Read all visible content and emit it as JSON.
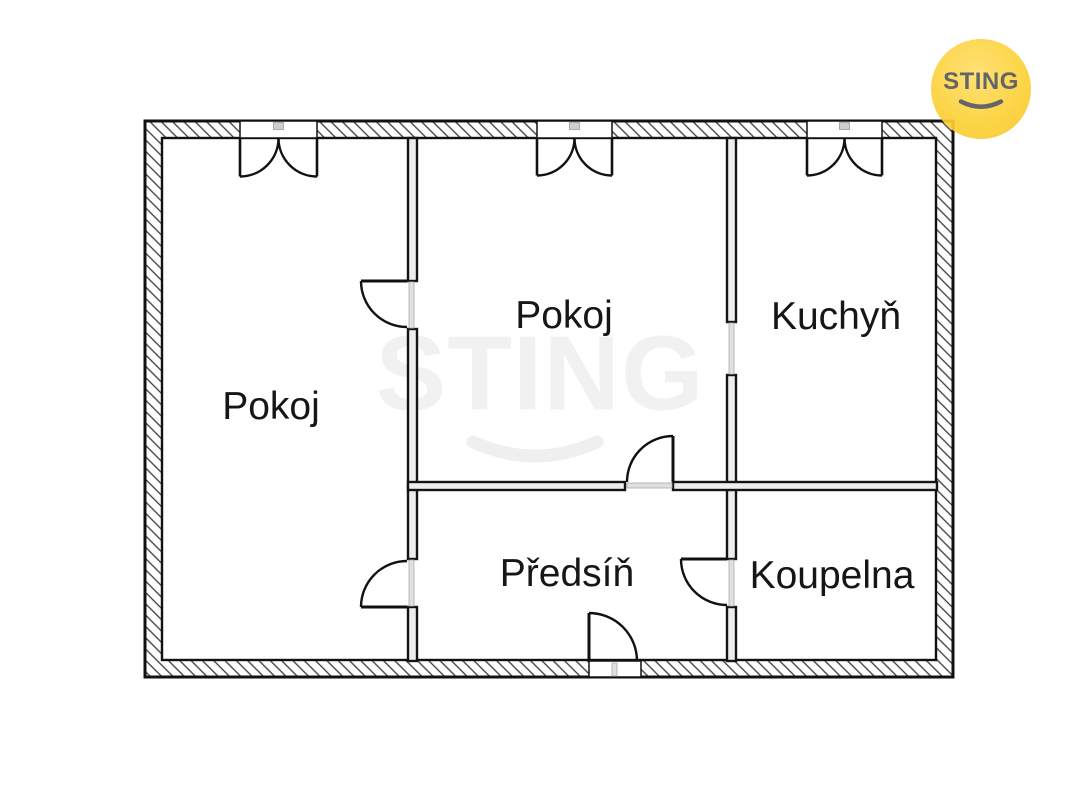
{
  "page": {
    "background": "#ffffff",
    "width": 1067,
    "height": 800
  },
  "branding": {
    "logo_text": "STING",
    "logo_circle_color": "#fbce2e",
    "logo_text_color": "#57585c",
    "watermark_text": "STING",
    "watermark_color": "#f1f1f1"
  },
  "floorplan": {
    "line_color": "#111111",
    "wall_core_color": "#ededed",
    "door_slab_color": "#e0e0e0",
    "outer": {
      "x": 145,
      "y": 121,
      "w": 808,
      "h": 556,
      "thickness": 17
    },
    "rooms": [
      {
        "id": "room-left",
        "label": "Pokoj",
        "cx": 271,
        "cy": 407
      },
      {
        "id": "room-middle",
        "label": "Pokoj",
        "cx": 564,
        "cy": 316
      },
      {
        "id": "kitchen",
        "label": "Kuchyň",
        "cx": 836,
        "cy": 317
      },
      {
        "id": "hall",
        "label": "Předsíň",
        "cx": 567,
        "cy": 574
      },
      {
        "id": "bathroom",
        "label": "Koupelna",
        "cx": 832,
        "cy": 576
      }
    ],
    "inner_walls": [
      {
        "id": "wall-left-rooms-top",
        "x": 408,
        "y": 138,
        "w": 9,
        "h": 143
      },
      {
        "id": "wall-left-rooms-mid",
        "x": 408,
        "y": 329,
        "w": 9,
        "h": 230
      },
      {
        "id": "wall-left-rooms-bottom",
        "x": 408,
        "y": 607,
        "w": 9,
        "h": 54
      },
      {
        "id": "wall-kitchen-top",
        "x": 727,
        "y": 138,
        "w": 9,
        "h": 184
      },
      {
        "id": "wall-kitchen-mid",
        "x": 727,
        "y": 375,
        "w": 9,
        "h": 184
      },
      {
        "id": "wall-kitchen-bottom",
        "x": 727,
        "y": 607,
        "w": 9,
        "h": 54
      },
      {
        "id": "wall-hall-left",
        "x": 408,
        "y": 482,
        "w": 217,
        "h": 8
      },
      {
        "id": "wall-hall-right",
        "x": 673,
        "y": 482,
        "w": 264,
        "h": 8
      }
    ],
    "windows": [
      {
        "id": "window-room-left",
        "x": 240,
        "w": 77
      },
      {
        "id": "window-room-middle",
        "x": 537,
        "w": 75
      },
      {
        "id": "window-kitchen",
        "x": 807,
        "w": 75
      }
    ],
    "passages": [
      {
        "id": "passage-kitchen",
        "slab": [
          729,
          323,
          5,
          51
        ]
      }
    ],
    "doors": [
      {
        "id": "door-room-left-upper",
        "slab": [
          409,
          282,
          5,
          46
        ],
        "leaf": [
          361,
          281,
          407,
          281
        ],
        "arc": "M 361 281 A 46 46 0 0 0 407 327"
      },
      {
        "id": "door-room-left-lower",
        "slab": [
          409,
          560,
          5,
          46
        ],
        "leaf": [
          361,
          607,
          407,
          607
        ],
        "arc": "M 361 607 A 46 46 0 0 1 407 561"
      },
      {
        "id": "door-bathroom",
        "slab": [
          729,
          560,
          5,
          46
        ],
        "leaf": [
          681,
          559,
          727,
          559
        ],
        "arc": "M 681 559 A 46 46 0 0 0 727 605"
      },
      {
        "id": "door-room-middle",
        "slab": [
          627,
          483,
          45,
          5
        ],
        "leaf": [
          673,
          436,
          673,
          482
        ],
        "arc": "M 673 436 A 46 46 0 0 0 627 482"
      },
      {
        "id": "door-entrance",
        "opening": [
          589,
          661,
          52,
          16
        ],
        "slab": [
          612,
          663,
          5,
          13
        ],
        "leaf": [
          589,
          613,
          589,
          661
        ],
        "arc": "M 589 613 A 48 48 0 0 1 637 661"
      }
    ]
  }
}
